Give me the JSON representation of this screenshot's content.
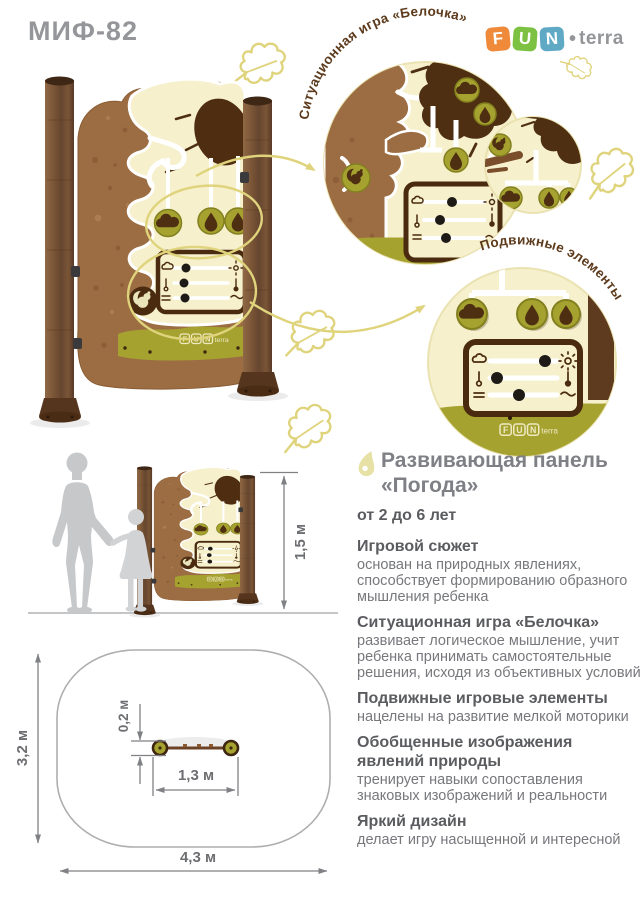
{
  "header": {
    "product_code": "МИФ-82",
    "brand": {
      "f": "F",
      "u": "U",
      "n": "N",
      "dot": "•",
      "suffix": "terra"
    }
  },
  "callouts": {
    "top": "Ситуационная игра «Белочка»",
    "bottom": "Подвижные элементы"
  },
  "dimensions": {
    "height": "1,5 м",
    "zone_depth": "3,2 м",
    "zone_length": "4,3 м",
    "panel_length": "1,3 м",
    "panel_depth": "0,2 м"
  },
  "info": {
    "title_line1": "Развивающая панель",
    "title_line2": "«Погода»",
    "bullets": [
      {
        "heading": "от 2 до 6 лет",
        "body": ""
      },
      {
        "heading": "Игровой сюжет",
        "body": "основан на природных явлениях, способствует формированию образного мышления ребенка"
      },
      {
        "heading": "Ситуационная игра «Белочка»",
        "body": "развивает логическое мышление, учит ребенка принимать самостоятельные решения, исходя из объективных условий"
      },
      {
        "heading": "Подвижные игровые элементы",
        "body": "нацелены на развитие мелкой моторики"
      },
      {
        "heading": "Обобщенные изображения явлений природы",
        "body": "тренирует навыки сопоставления знаковых изображений и реальности"
      },
      {
        "heading": "Яркий дизайн",
        "body": "делает игру насыщенной и интересной"
      }
    ]
  },
  "colors": {
    "cream": "#F6F0CD",
    "cork": "#9C6D42",
    "olive": "#A5A230",
    "dark_brown": "#4A2B10",
    "wood": "#7A5536",
    "decor_yellow": "#DFD37C",
    "bullet_icon": "#E7E1A5",
    "brand_orange": "#EF8A3B",
    "brand_green": "#7CC142",
    "brand_blue": "#5FA9C5",
    "logo_gray": "#939598",
    "title_gray": "#7E8086",
    "heading_gray": "#5B5C5F",
    "body_gray": "#77787C",
    "dimension_gray": "#6D6E71",
    "silhouette_gray": "#C7C8CA",
    "callout_text_brown": "#5C3A1C"
  }
}
